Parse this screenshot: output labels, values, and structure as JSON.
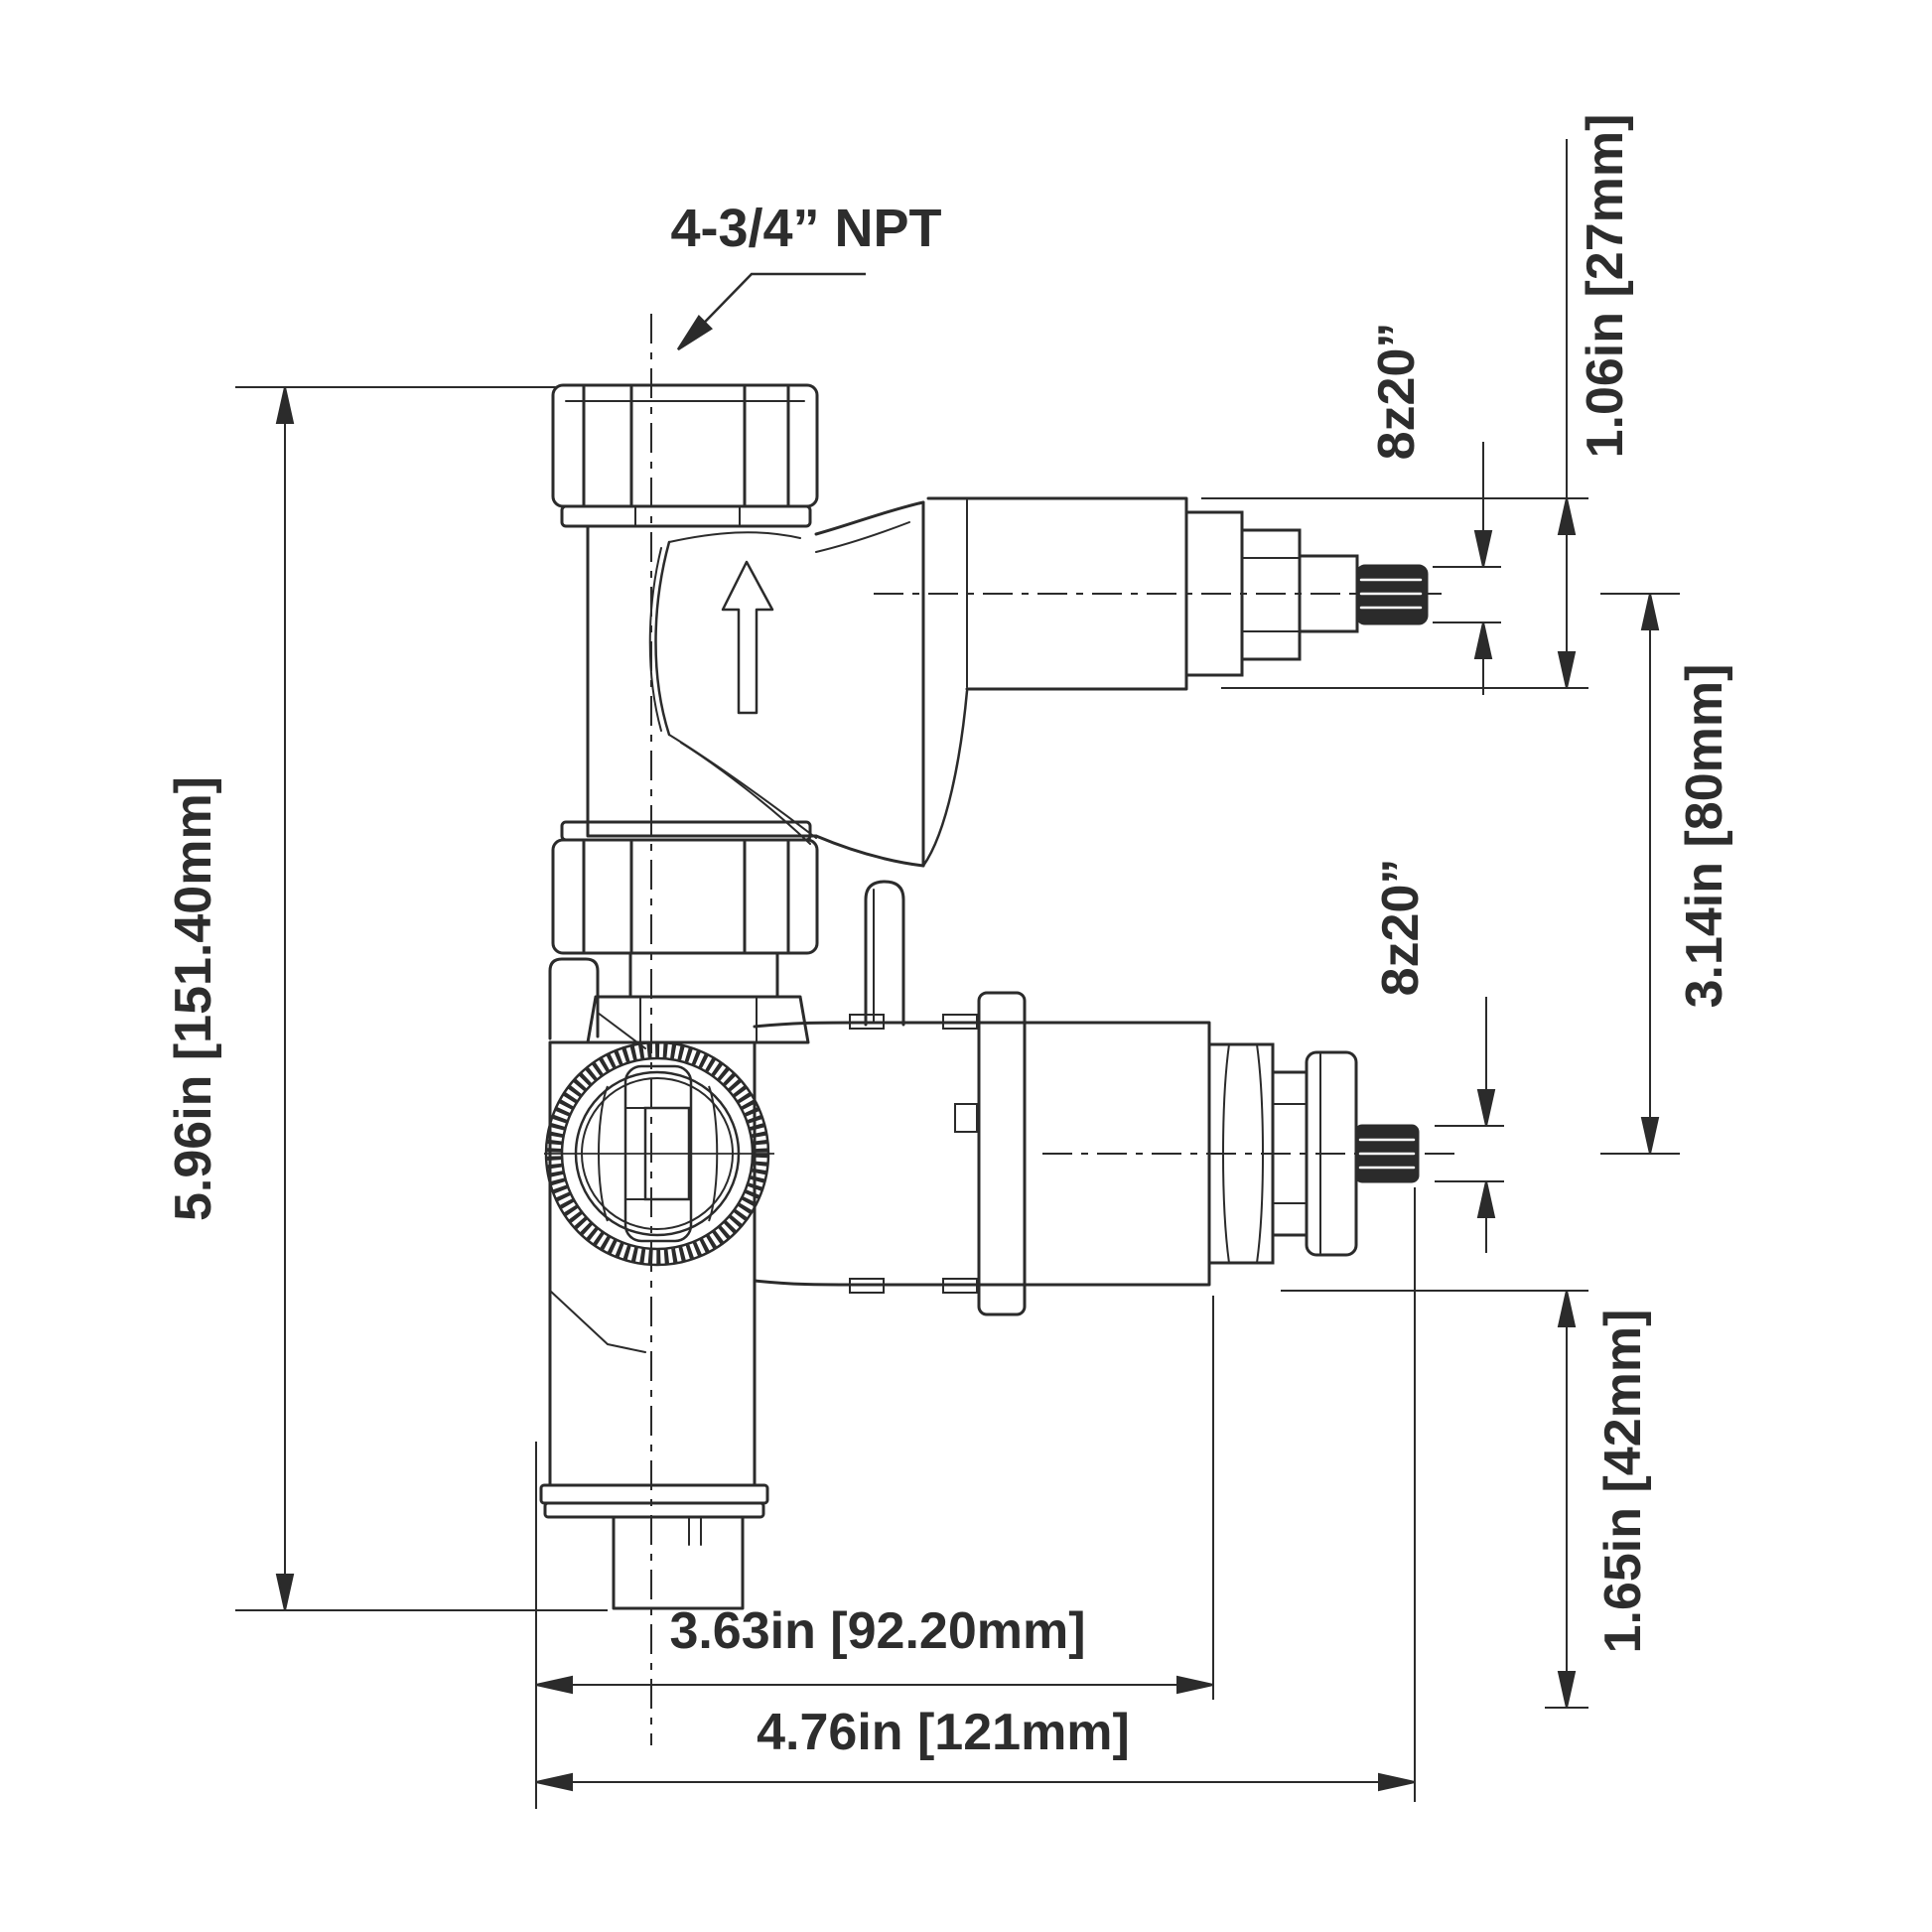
{
  "drawing": {
    "type": "technical-dimension-drawing",
    "subject": "thermostatic shower valve rough-in, side elevation",
    "colors": {
      "line": "#2b2b2b",
      "text": "#2d2d2d",
      "background": "#ffffff"
    },
    "labels": {
      "npt_port": "4-3/4” NPT",
      "spline_top": "8z20”",
      "cartridge_diameter": "1.06in [27mm]",
      "spline_bottom": "8z20”",
      "port_offset": "3.14in [80mm]",
      "bottom_offset": "1.65in [42mm]",
      "total_height": "5.96in [151.40mm]",
      "depth_inner": "3.63in [92.20mm]",
      "depth_outer": "4.76in [121mm]"
    }
  }
}
